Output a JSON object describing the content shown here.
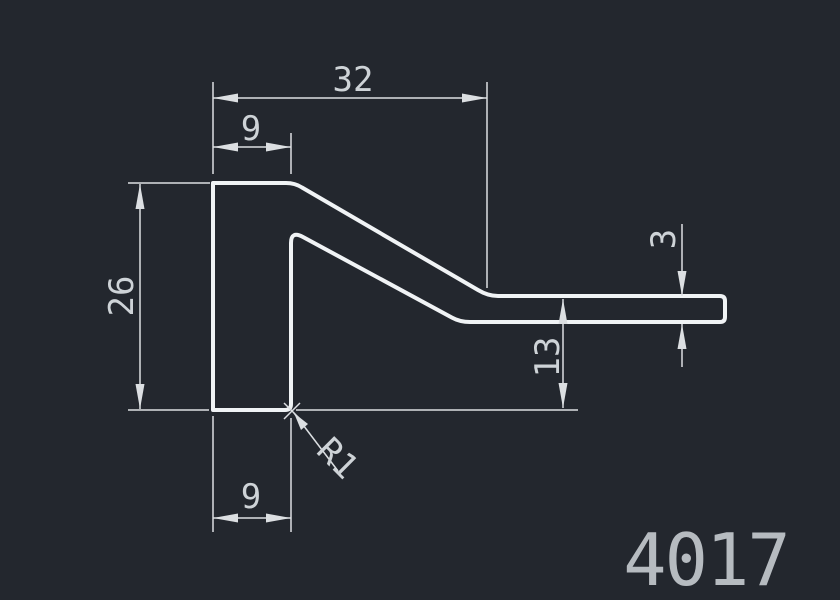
{
  "colors": {
    "background": "#23272e",
    "profile_stroke": "#f0f3f5",
    "dimension_stroke": "#dcdfe2",
    "text_color": "#ced3d7",
    "part_number_color": "#b6bbc0"
  },
  "dimensions": {
    "overall_width": "32",
    "top_leg_width": "9",
    "left_height": "26",
    "step_height": "13",
    "flange_thickness": "3",
    "bottom_leg_width": "9",
    "fillet_radius": "R1"
  },
  "part_number": "4017"
}
